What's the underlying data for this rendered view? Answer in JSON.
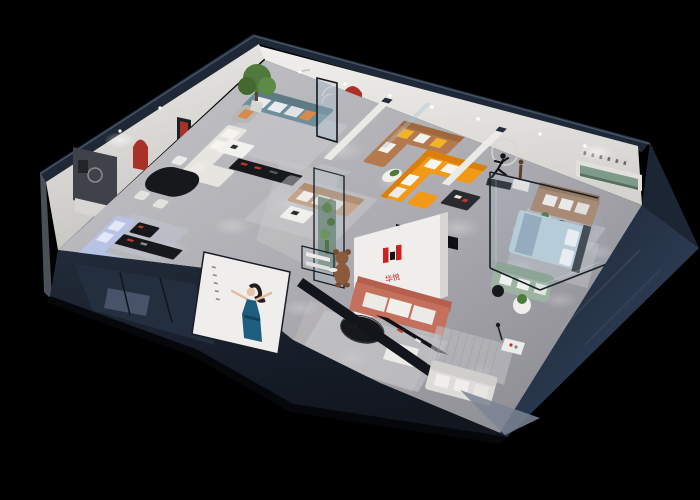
{
  "scene": {
    "description": "3D isometric dollhouse cutaway render of a furniture brand showroom at night, black background, dark navy exterior walls, white interior walls, gray floors, ceiling spotlights",
    "view": "axonometric top-down from south-west"
  },
  "brand": {
    "name": "华悦",
    "mark": "H monogram of red and black blocks",
    "logo_red": "#c8231e",
    "logo_black": "#141414"
  },
  "poster": {
    "subject": "hostess figure in dark blue evening dress, arms raised",
    "panel_color": "#f4f3f1",
    "side_caption": {
      "legible": false,
      "orientation": "vertical"
    }
  },
  "signage": {
    "right_wall_lettering": {
      "characters": 6,
      "legible": false
    },
    "entry_wall_slogan": {
      "lines": 2,
      "legible": false
    }
  },
  "rooms": [
    {
      "name": "lounge-display",
      "furniture": [
        "teal fabric sofa with white and orange pillows",
        "large potted tree",
        "gray armchair with orange pillow",
        "white L-shaped sofa",
        "white coffee table",
        "black media console with red accents",
        "curved-line wall decor",
        "area rug"
      ]
    },
    {
      "name": "dining-display",
      "furniture": [
        "black oval dining table",
        "four white chairs",
        "dark feature wall with framed art",
        "white sideboard",
        "red arched wall niche",
        "slim red display niche"
      ]
    },
    {
      "name": "periwinkle-sofa-display",
      "furniture": [
        "light periwinkle blue sectional sofa",
        "black coffee table",
        "long black media console",
        "pale rug"
      ]
    },
    {
      "name": "entry-gallery",
      "furniture": [
        "caramel leather corner sofa with yellow pillows",
        "red arched niche with figurine",
        "round side table with plant",
        "freestanding glass door panel",
        "tall glass vitrine with cacti",
        "glass display counter",
        "teddy-bear mascot figure"
      ]
    },
    {
      "name": "orange-sectional-display",
      "furniture": [
        "bright orange L-shaped sectional with white pillows",
        "orange ottoman",
        "dark coffee table",
        "running-man sculpture with ring wall decor"
      ]
    },
    {
      "name": "taupe-sofa-display",
      "furniture": [
        "taupe three-seat sofa with white pillows",
        "recessed sage-green display shelf",
        "bronze statuette on white pedestal",
        "striped rug",
        "black round side table",
        "plant table"
      ]
    },
    {
      "name": "glass-bedroom-display",
      "furniture": [
        "light blue double bed with dark headboard",
        "sage green sofa",
        "round white table with plant",
        "striped rug",
        "full-height glass partition"
      ]
    },
    {
      "name": "main-showroom",
      "furniture": [
        "salmon sofa with light cushions",
        "black oval coffee table",
        "white ottoman",
        "long black display console with red accents",
        "brand logo wall",
        "black ceiling slab"
      ]
    },
    {
      "name": "front-lounge-display",
      "furniture": [
        "white sofa",
        "striped rug",
        "small white serving table",
        "floor lamp"
      ]
    }
  ],
  "palette": {
    "bg": "#000000",
    "navy": "#1f2836",
    "navy-deep": "#131a26",
    "navy-mid": "#2a3649",
    "roof-edge": "#45546e",
    "wall-white": "#e9e7e3",
    "wall-dim": "#d2d0cc",
    "floor-light": "#bfbfc4",
    "floor-dark": "#8d8d94",
    "rug": "#c9c9cd",
    "teal-sofa": "#6e8e9a",
    "periwinkle": "#b7c3e4",
    "tan-sofa": "#c4a58c",
    "caramel": "#b5794e",
    "orange": "#f29a18",
    "orange-deep": "#d97f0a",
    "salmon": "#c5705c",
    "taupe": "#a8856d",
    "sage": "#9db3a2",
    "bed-blue": "#b9cdda",
    "red-accent": "#a83228",
    "console-dark": "#17181c",
    "plant-green": "#4f7a3c",
    "sage-wall": "#5f7a66",
    "bronze": "#5d3f28",
    "bear-brown": "#8a5a3a",
    "glass": "#aac4d4",
    "dress-blue": "#1d5e7e",
    "white-soft": "#efeeec",
    "skin": "#e8c2a4"
  }
}
